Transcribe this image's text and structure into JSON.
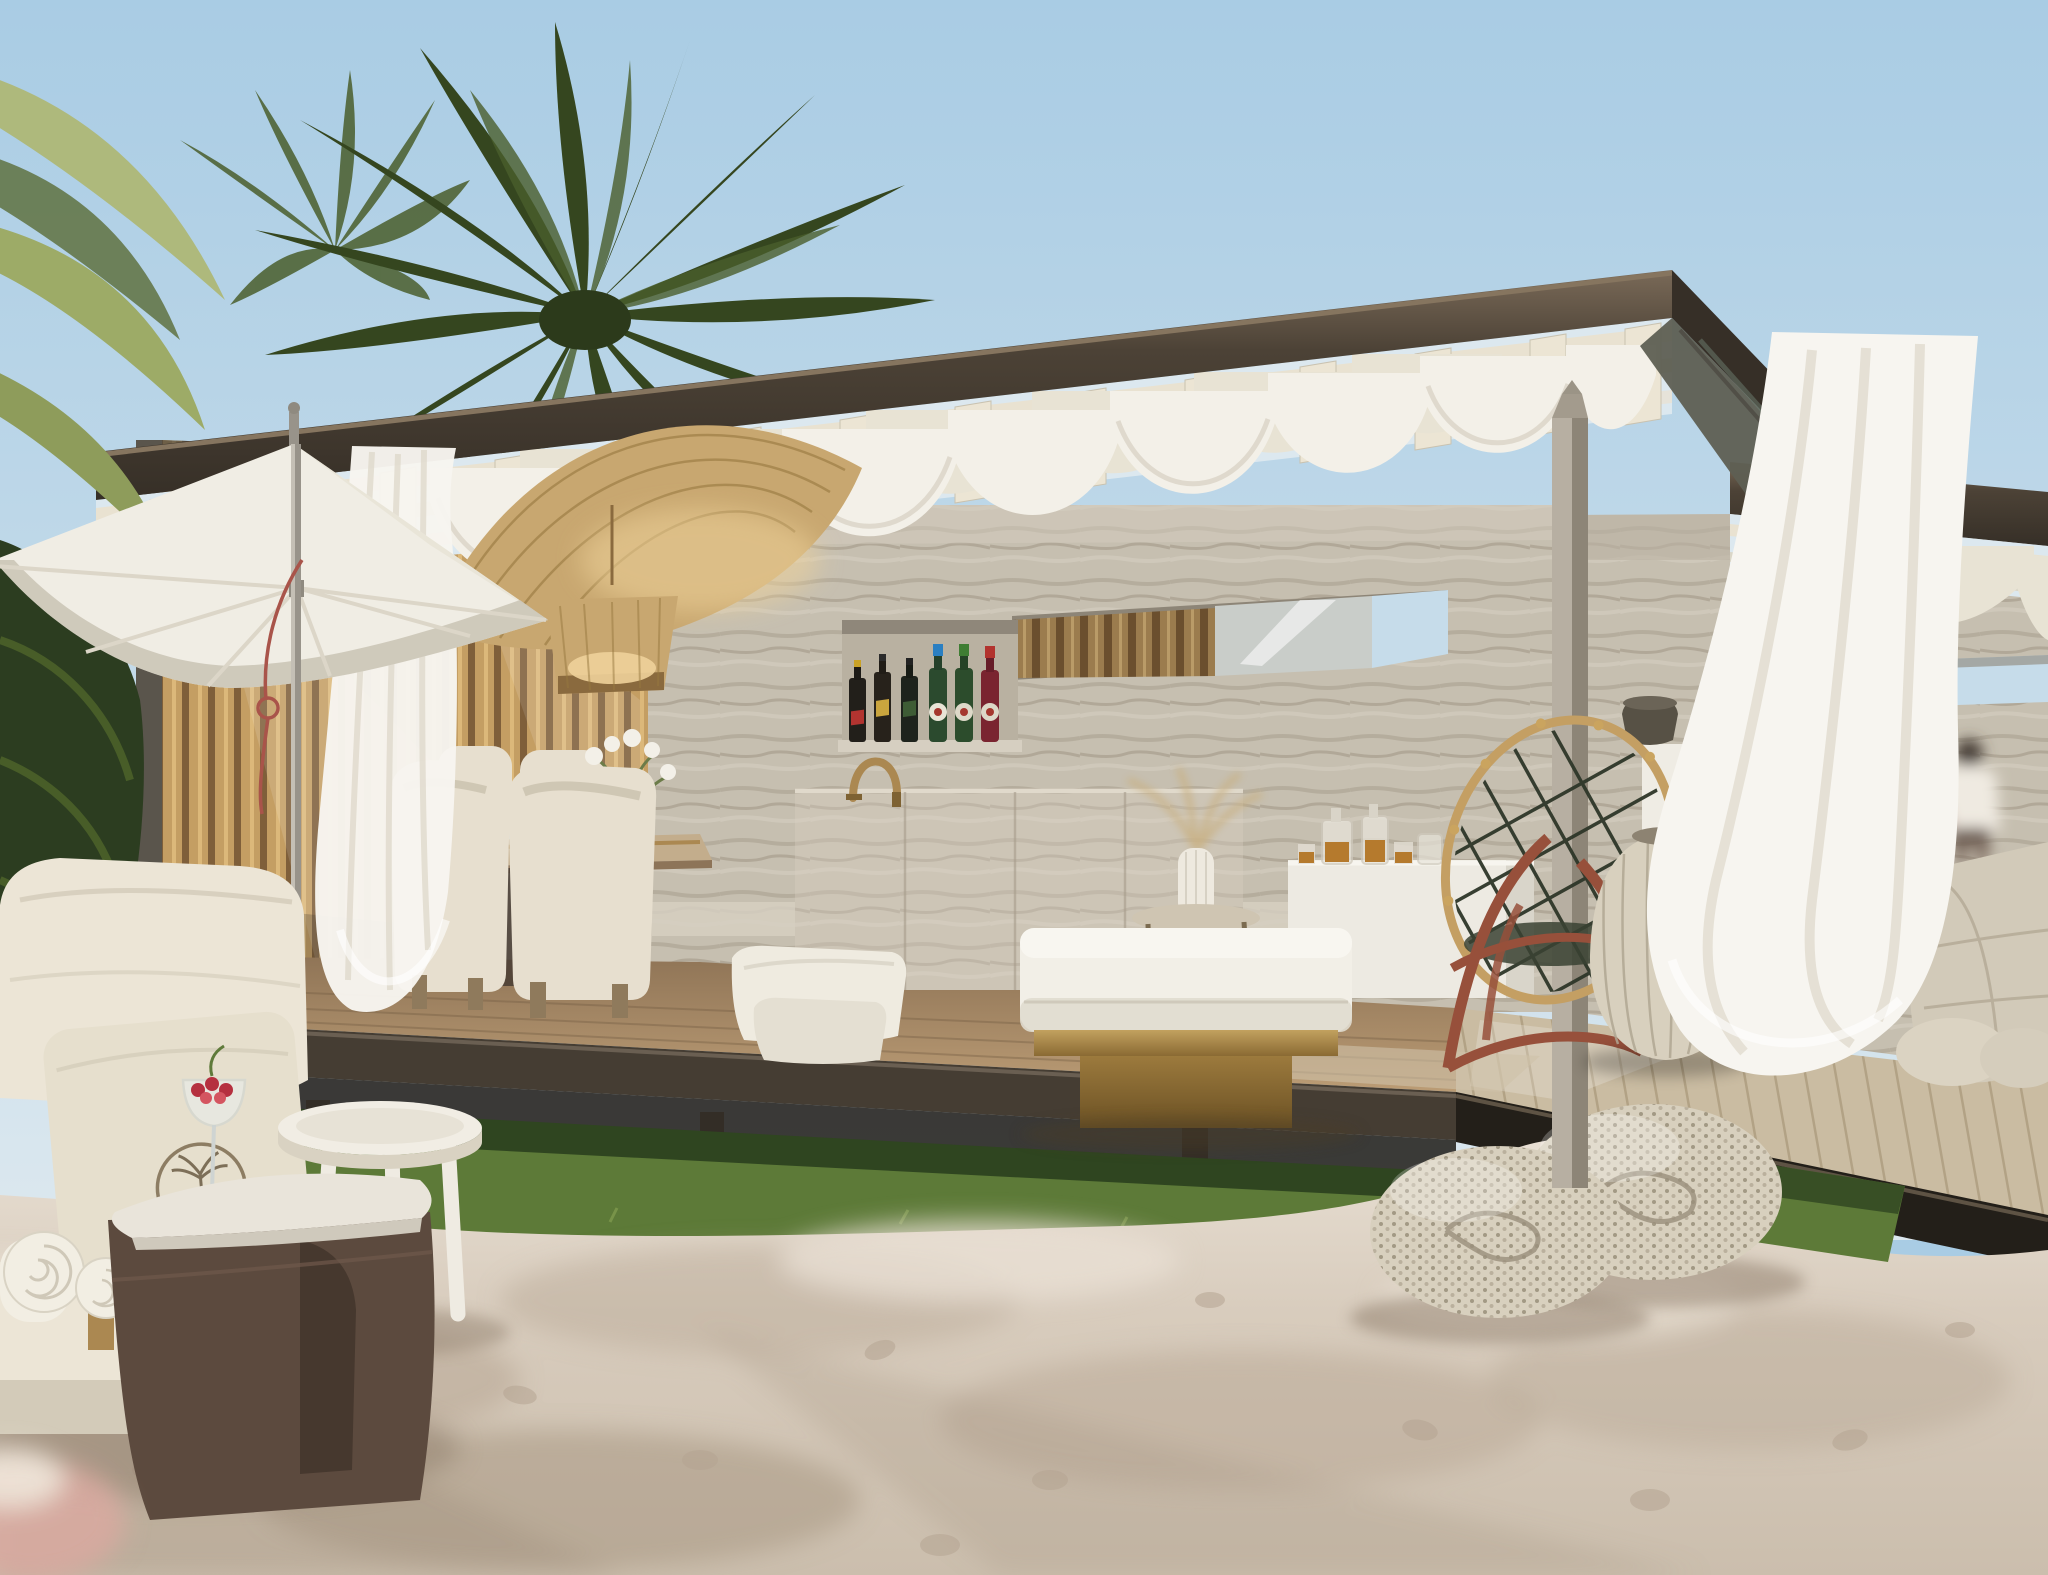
{
  "meta": {
    "title": "Beachfront cabana pavilion — photorealistic exterior render",
    "width": 2048,
    "height": 1575,
    "time_of_day": "sunny midday",
    "setting": "sandy beach with lawn strip, palm trees and open-air travertine pavilion"
  },
  "scene": {
    "objects": [
      {
        "id": 0,
        "label": "clear blue sky"
      },
      {
        "id": 1,
        "label": "distant second pavilion bay with travertine walls"
      },
      {
        "id": 2,
        "label": "blurred person walking behind pavilion"
      },
      {
        "id": 3,
        "label": "palm trees"
      },
      {
        "id": 4,
        "label": "vertical oak slat wall of dining alcove"
      },
      {
        "id": 5,
        "label": "travertine stone back wall with slot window"
      },
      {
        "id": 6,
        "label": "bar niche shelf with whisky and vermouth bottles"
      },
      {
        "id": 7,
        "label": "flat bronze roof with cream pergola slats"
      },
      {
        "id": 8,
        "label": "white draped fabric swags under pergola"
      },
      {
        "id": 9,
        "label": "raised wooden deck platform"
      },
      {
        "id": 10,
        "label": "green lawn strip under platform"
      },
      {
        "id": 11,
        "label": "sandy beach foreground with footprints"
      },
      {
        "id": 12,
        "label": "two woven wicker poufs on sand"
      },
      {
        "id": 13,
        "label": "woven rattan pendant lamps"
      },
      {
        "id": 14,
        "label": "dining table with cream barrel chairs"
      },
      {
        "id": 15,
        "label": "travertine bar counter"
      },
      {
        "id": 16,
        "label": "white drinks console with decanters"
      },
      {
        "id": 17,
        "label": "daybed with white mattress on brass plinth"
      },
      {
        "id": 18,
        "label": "red-brown rattan lounge chair with lattice back"
      },
      {
        "id": 19,
        "label": "stone structural post"
      },
      {
        "id": 20,
        "label": "white pedestal with dark stone bowl"
      },
      {
        "id": 21,
        "label": "large wicker floor lantern"
      },
      {
        "id": 22,
        "label": "raw-edge marble monolith table"
      },
      {
        "id": 23,
        "label": "sheer white curtains blowing in breeze"
      },
      {
        "id": 24,
        "label": "white patio umbrella with red cord"
      },
      {
        "id": 25,
        "label": "cream outdoor sofa with emblem pillow"
      },
      {
        "id": 26,
        "label": "white tripod side table"
      },
      {
        "id": 27,
        "label": "coupe cocktail glass with red berries"
      },
      {
        "id": 28,
        "label": "left cabana module with slat cladding"
      },
      {
        "id": 29,
        "label": "brass arc faucet"
      },
      {
        "id": 30,
        "label": "glass vase with white flowers"
      },
      {
        "id": 31,
        "label": "rolled white towels"
      },
      {
        "id": 32,
        "label": "brown velvet ottoman table with stone top"
      }
    ],
    "bottle_lineup": [
      {
        "name": "whisky bottle, red label",
        "body": "#221f1a",
        "label_color": "#b23430",
        "cap": "#c9a227"
      },
      {
        "name": "whisky bottle, gold slash label",
        "body": "#27221b",
        "label_color": "#caa53e",
        "cap": "#2b2b2b"
      },
      {
        "name": "whisky bottle, green label",
        "body": "#1e231c",
        "label_color": "#3e5c35",
        "cap": "#222222"
      },
      {
        "name": "vermouth bottle, blue cap",
        "body": "#2b4a2e",
        "label_color": "#e8e4d6",
        "cap": "#2a7fc2"
      },
      {
        "name": "vermouth bottle, green cap",
        "body": "#2c4c2c",
        "label_color": "#ddd8c8",
        "cap": "#3f7d33"
      },
      {
        "name": "vermouth bottle, red cap",
        "body": "#7a2430",
        "label_color": "#ddd8c8",
        "cap": "#b2332e"
      }
    ]
  },
  "palette": {
    "sky-top": "#a9cce4",
    "sky-mid": "#c6dcea",
    "sky-low": "#dce8ef",
    "palm-dark": "#35461f",
    "palm-mid": "#4a5e2c",
    "palm-deep": "#2c3d20",
    "palm-light": "#93a55c",
    "palm-pale": "#aeb97c",
    "fascia": "#4c4236",
    "fascia-dark": "#362f27",
    "fascia-hi": "#7a6a58",
    "soffit": "#5e5f53",
    "slat-cream": "#e9e2d1",
    "slat-cream2": "#d9d2bf",
    "swag": "#f3f0e8",
    "swag-shadow": "#d9d3c5",
    "swag-deep": "#e8e3d4",
    "trav": "#c6bfb0",
    "trav-stripe": "#a89e8d",
    "trav-light": "#d6cfc1",
    "woodslat": "#c49e63",
    "woodslat-dark": "#7f5f3a",
    "woodslat-hi": "#e2be80",
    "niche": "#b9b1a1",
    "glass-refl": "#c9cdc9",
    "brass": "#ab8851",
    "brass-dark": "#7e6233",
    "lamp-tan": "#c8a770",
    "lamp-glow": "#eed29a",
    "lamp-line": "#97783f",
    "chair-cream": "#e7dfcf",
    "table-wood": "#c3ad8c",
    "counter": "#cdc6b7",
    "console": "#edeae2",
    "amber": "#b57a2d",
    "mattress": "#f2efe7",
    "mattress-shade": "#e0dbcf",
    "pillow": "#efebe0",
    "chair-red": "#97503b",
    "lattice": "#2f3a2c",
    "post-light": "#b7afa2",
    "post-dark": "#8d8577",
    "pedestal": "#efece4",
    "bowl": "#575145",
    "wicker": "#d8d0be",
    "wicker-line": "#b1a793",
    "curtain": "#f7f5f0",
    "curtain-shade": "#ded8ca",
    "stone": "#d2cab9",
    "stone-line": "#b3a995",
    "deck": "#8f7456",
    "deck-light": "#bb9c75",
    "deck-right": "#cabca2",
    "deck-line": "#9a8868",
    "platform": "#453d33",
    "platform-dark": "#231f19",
    "grass": "#5d7a38",
    "grass-dark": "#2f4520",
    "grass-light": "#7f9a4e",
    "sand": "#d8ccbd",
    "sand-dark": "#b5a492",
    "sand-light": "#e8dfd3",
    "sand-shadow": "#a5937f",
    "sofa": "#ece5d6",
    "sofa-shadow": "#d3cbb9",
    "ottoman": "#5c4a3e",
    "ottoman-dark": "#46382e",
    "ottoman-top": "#e9e4da",
    "towel": "#f2eee3",
    "berry": "#b5303f",
    "rope-red": "#a9544a",
    "person-shirt": "#efeae1",
    "person-skin": "#4a3f38",
    "umbrella": "#f0ede4",
    "umbrella-shade": "#dcd6c8",
    "umbrella-dark": "#c9c3b4",
    "pole": "#98938a"
  }
}
